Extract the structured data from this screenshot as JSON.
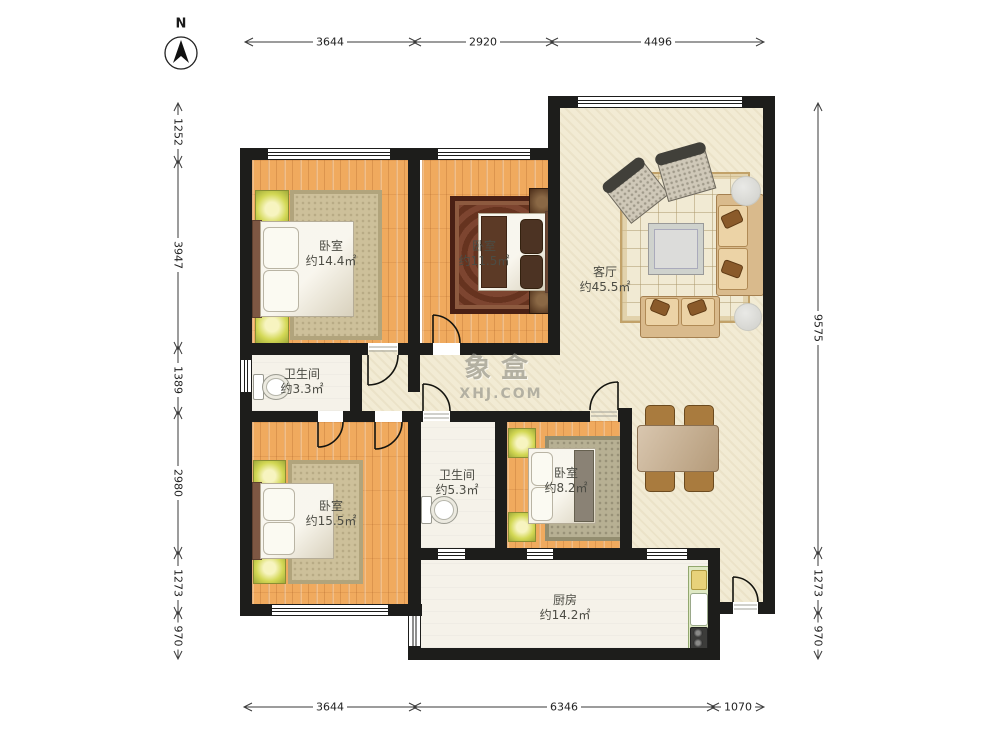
{
  "north_label": "N",
  "watermark": {
    "brand": "象盒",
    "site": "XHJ.COM"
  },
  "rooms": {
    "bedroom_tl": {
      "name": "卧室",
      "area": "约14.4㎡"
    },
    "bedroom_tm": {
      "name": "卧室",
      "area": "约11.5㎡"
    },
    "living_room": {
      "name": "客厅",
      "area": "约45.5㎡"
    },
    "bath_top": {
      "name": "卫生间",
      "area": "约3.3㎡"
    },
    "bedroom_bl": {
      "name": "卧室",
      "area": "约15.5㎡"
    },
    "bath_mid": {
      "name": "卫生间",
      "area": "约5.3㎡"
    },
    "bedroom_bm": {
      "name": "卧室",
      "area": "约8.2㎡"
    },
    "kitchen": {
      "name": "厨房",
      "area": "约14.2㎡"
    }
  },
  "dimensions": {
    "top": [
      "3644",
      "2920",
      "4496"
    ],
    "bottom": [
      "3644",
      "6346",
      "1070"
    ],
    "left": [
      "1252",
      "3947",
      "1389",
      "2980",
      "1273",
      "970"
    ],
    "right": [
      "9575",
      "1273",
      "970"
    ]
  }
}
